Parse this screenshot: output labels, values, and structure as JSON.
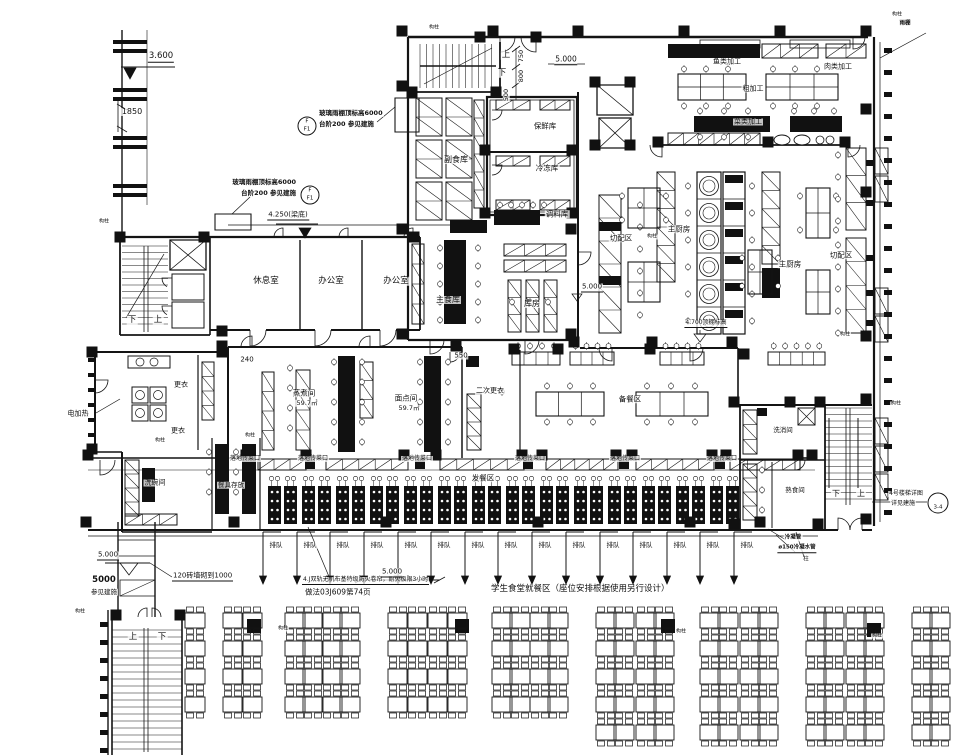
{
  "drawing": {
    "type": "cafeteria-kitchen-floor-plan",
    "main_note": "学生食堂就餐区（座位安排根据使用另行设计）",
    "fire_curtain_note_1": "4.J双轨无机布基特级防火卷帘，耐火极限3小时",
    "fire_curtain_note_2": "做法03J609第74页"
  },
  "queue": {
    "text": "排队",
    "y": 545,
    "xs": [
      273,
      307,
      340,
      374,
      408,
      441,
      475,
      508,
      542,
      576,
      610,
      643,
      677,
      710,
      744
    ]
  },
  "pass_windows": {
    "text": "落地传菜口",
    "y": 459,
    "xs": [
      245,
      313,
      417,
      530,
      625,
      722
    ]
  },
  "column_marks": {
    "text": "构柱",
    "positions": [
      [
        434,
        28
      ],
      [
        897,
        15
      ],
      [
        104,
        222
      ],
      [
        250,
        436
      ],
      [
        160,
        441
      ],
      [
        652,
        237
      ],
      [
        845,
        335
      ],
      [
        283,
        629
      ],
      [
        681,
        632
      ],
      [
        877,
        636
      ],
      [
        80,
        612
      ],
      [
        896,
        404
      ]
    ]
  },
  "stations": {
    "count": 14,
    "x0": 268,
    "dx": 34,
    "y": 486
  },
  "labels": [
    {
      "t": "3.600",
      "x": 161,
      "y": 57,
      "fs": 8.5,
      "ul": 1,
      "n": "dim-3600"
    },
    {
      "t": "1850",
      "x": 132,
      "y": 112,
      "fs": 8,
      "n": "dim-1850"
    },
    {
      "t": "玻璃雨棚顶标高6000",
      "x": 318,
      "y": 113,
      "fs": 6.5,
      "ha": "left",
      "b": 1,
      "n": "canopy-callout-1-line1"
    },
    {
      "t": "台阶200  参见建施",
      "x": 318,
      "y": 124,
      "fs": 6.5,
      "ha": "left",
      "b": 1,
      "n": "canopy-callout-1-line2"
    },
    {
      "t": "玻璃雨棚顶标高6000",
      "x": 297,
      "y": 182,
      "fs": 6.5,
      "ha": "right",
      "b": 1,
      "n": "canopy-callout-2-line1"
    },
    {
      "t": "台阶200  参见建施",
      "x": 297,
      "y": 193,
      "fs": 6.5,
      "ha": "right",
      "b": 1,
      "n": "canopy-callout-2-line2"
    },
    {
      "t": "4.250(梁底)",
      "x": 288,
      "y": 216,
      "fs": 7,
      "ul": 1,
      "n": "dim-4250"
    },
    {
      "t": "5.000",
      "x": 566,
      "y": 60,
      "fs": 7.5,
      "ul": 1,
      "n": "dim-5000-top"
    },
    {
      "t": "750",
      "x": 521,
      "y": 56,
      "fs": 6.5,
      "rot": 1,
      "n": "dim-750"
    },
    {
      "t": "800",
      "x": 521,
      "y": 76,
      "fs": 6.5,
      "rot": 1,
      "n": "dim-800"
    },
    {
      "t": "500",
      "x": 506,
      "y": 95,
      "fs": 6.5,
      "rot": 1,
      "n": "dim-500"
    },
    {
      "t": "上",
      "x": 506,
      "y": 55,
      "fs": 8.5,
      "n": "stair-up-top"
    },
    {
      "t": "下",
      "x": 502,
      "y": 73,
      "fs": 8.5,
      "n": "stair-down-top"
    },
    {
      "t": "副食库",
      "x": 456,
      "y": 160,
      "fs": 8,
      "n": "room-label-side-food-store"
    },
    {
      "t": "保鲜库",
      "x": 545,
      "y": 126,
      "fs": 7.5,
      "n": "room-label-fresh-store"
    },
    {
      "t": "冷冻库",
      "x": 547,
      "y": 168,
      "fs": 7.5,
      "n": "room-label-freezer"
    },
    {
      "t": "调料库",
      "x": 557,
      "y": 214,
      "fs": 7.5,
      "n": "room-label-seasoning-store"
    },
    {
      "t": "主食库",
      "x": 448,
      "y": 300,
      "fs": 8,
      "n": "room-label-staple-store"
    },
    {
      "t": "库房",
      "x": 532,
      "y": 304,
      "fs": 8,
      "n": "room-label-storeroom"
    },
    {
      "t": "5.000",
      "x": 592,
      "y": 288,
      "fs": 7,
      "ul": 1,
      "n": "dim-5000-mid"
    },
    {
      "t": "切配区",
      "x": 621,
      "y": 238,
      "fs": 7.5,
      "n": "zone-label-cutting-1"
    },
    {
      "t": "切配区",
      "x": 841,
      "y": 255,
      "fs": 7.5,
      "n": "zone-label-cutting-2"
    },
    {
      "t": "主厨房",
      "x": 679,
      "y": 229,
      "fs": 7.5,
      "n": "room-label-main-kitchen-1"
    },
    {
      "t": "主厨房",
      "x": 790,
      "y": 264,
      "fs": 7.5,
      "n": "room-label-main-kitchen-2"
    },
    {
      "t": "鱼类加工",
      "x": 727,
      "y": 62,
      "fs": 7,
      "n": "zone-label-fish-processing"
    },
    {
      "t": "肉类加工",
      "x": 838,
      "y": 67,
      "fs": 7,
      "n": "zone-label-meat-processing"
    },
    {
      "t": "粗加工",
      "x": 753,
      "y": 89,
      "fs": 7,
      "n": "zone-label-rough-processing"
    },
    {
      "t": "菜类加工",
      "x": 748,
      "y": 122,
      "fs": 7,
      "n": "zone-label-vegetable-processing"
    },
    {
      "t": "4.700顶棚标高",
      "x": 706,
      "y": 324,
      "fs": 6,
      "ul": 1,
      "n": "dim-4700-ceiling"
    },
    {
      "t": "休息室",
      "x": 266,
      "y": 281,
      "fs": 8.5,
      "n": "room-label-rest-room"
    },
    {
      "t": "办公室",
      "x": 331,
      "y": 281,
      "fs": 8.5,
      "n": "room-label-office-1"
    },
    {
      "t": "办公室",
      "x": 396,
      "y": 281,
      "fs": 8.5,
      "n": "room-label-office-2"
    },
    {
      "t": "下",
      "x": 132,
      "y": 320,
      "fs": 8.5,
      "n": "stair-down-left"
    },
    {
      "t": "上",
      "x": 158,
      "y": 320,
      "fs": 8.5,
      "n": "stair-up-left"
    },
    {
      "t": "更衣",
      "x": 181,
      "y": 385,
      "fs": 7,
      "n": "room-label-changing-1"
    },
    {
      "t": "更衣",
      "x": 178,
      "y": 431,
      "fs": 7,
      "n": "room-label-changing-2"
    },
    {
      "t": "电加热",
      "x": 78,
      "y": 414,
      "fs": 7,
      "n": "note-electric-heating"
    },
    {
      "t": "洗碗间",
      "x": 155,
      "y": 483,
      "fs": 7,
      "n": "room-label-dishwashing"
    },
    {
      "t": "餐具存放",
      "x": 231,
      "y": 485,
      "fs": 6.5,
      "n": "room-label-tableware-storage"
    },
    {
      "t": "蒸煮间",
      "x": 304,
      "y": 393,
      "fs": 7.5,
      "n": "room-label-steaming"
    },
    {
      "t": "59.7㎡",
      "x": 307,
      "y": 403,
      "fs": 6.5,
      "n": "area-steaming"
    },
    {
      "t": "面点间",
      "x": 406,
      "y": 398,
      "fs": 7.5,
      "n": "room-label-pastry"
    },
    {
      "t": "59.7㎡",
      "x": 409,
      "y": 408,
      "fs": 6.5,
      "n": "area-pastry"
    },
    {
      "t": "240",
      "x": 247,
      "y": 360,
      "fs": 7,
      "n": "dim-240"
    },
    {
      "t": "550",
      "x": 461,
      "y": 356,
      "fs": 7,
      "n": "dim-550"
    },
    {
      "t": "二次更衣",
      "x": 490,
      "y": 391,
      "fs": 7,
      "n": "room-label-second-changing"
    },
    {
      "t": "备餐区",
      "x": 630,
      "y": 399,
      "fs": 7.5,
      "n": "zone-label-food-prep"
    },
    {
      "t": "发餐区",
      "x": 483,
      "y": 478,
      "fs": 7.5,
      "n": "zone-label-serving"
    },
    {
      "t": "洗消间",
      "x": 783,
      "y": 430,
      "fs": 6.5,
      "n": "room-label-washing-disinfection"
    },
    {
      "t": "熟食间",
      "x": 795,
      "y": 490,
      "fs": 6.5,
      "n": "room-label-cooked-food"
    },
    {
      "t": "学生食堂就餐区（座位安排根据使用另行设计）",
      "x": 490,
      "y": 589,
      "fs": 8.5,
      "ha": "left",
      "n": "note-dining-area"
    },
    {
      "t": "4.J双轨无机布基特级防火卷帘，耐火极限3小时",
      "x": 302,
      "y": 581,
      "fs": 6,
      "ha": "left",
      "ul": 1,
      "n": "note-fire-curtain-1"
    },
    {
      "t": "做法03J609第74页",
      "x": 304,
      "y": 592,
      "fs": 7.5,
      "ha": "left",
      "n": "note-fire-curtain-2"
    },
    {
      "t": "5.000",
      "x": 392,
      "y": 573,
      "fs": 7,
      "ul": 1,
      "n": "dim-5000-bottom"
    },
    {
      "t": "5.000",
      "x": 108,
      "y": 556,
      "fs": 7,
      "ul": 1,
      "n": "dim-5000-left"
    },
    {
      "t": "5000",
      "x": 104,
      "y": 580,
      "fs": 8.5,
      "b": 1,
      "n": "dim-5000-bold"
    },
    {
      "t": "参见建施",
      "x": 104,
      "y": 592,
      "fs": 6.5,
      "n": "note-see-arch"
    },
    {
      "t": "120砖墙砌到1000",
      "x": 172,
      "y": 577,
      "fs": 7,
      "ha": "left",
      "ul": 1,
      "n": "note-brick-wall"
    },
    {
      "t": "上",
      "x": 133,
      "y": 637,
      "fs": 8.5,
      "n": "stair-up-bottom-left"
    },
    {
      "t": "下",
      "x": 162,
      "y": 637,
      "fs": 8.5,
      "n": "stair-down-bottom-left"
    },
    {
      "t": "4号楼梯详图",
      "x": 906,
      "y": 494,
      "fs": 6,
      "n": "callout-stair4-line1"
    },
    {
      "t": "详见建施",
      "x": 903,
      "y": 504,
      "fs": 6,
      "n": "callout-stair4-line2"
    },
    {
      "t": "3-4",
      "x": 938,
      "y": 508,
      "fs": 5.5,
      "n": "callout-stair4-ref"
    },
    {
      "t": "下",
      "x": 836,
      "y": 494,
      "fs": 8,
      "n": "stair-down-right"
    },
    {
      "t": "上",
      "x": 861,
      "y": 494,
      "fs": 8,
      "n": "stair-up-right"
    },
    {
      "t": "冷凝管",
      "x": 793,
      "y": 538,
      "fs": 5.5,
      "b": 1,
      "n": "note-condensate-pipe"
    },
    {
      "t": "ø150冷凝水管",
      "x": 797,
      "y": 549,
      "fs": 5.5,
      "b": 1,
      "ul": 1,
      "n": "note-condensate-150"
    },
    {
      "t": "柱",
      "x": 806,
      "y": 560,
      "fs": 5.5,
      "n": "note-column"
    },
    {
      "t": "雨棚",
      "x": 905,
      "y": 24,
      "fs": 5.5,
      "b": 1,
      "n": "note-canopy"
    },
    {
      "t": "F",
      "x": 307,
      "y": 122,
      "fs": 5.5,
      "n": "callout-bubble-1-top"
    },
    {
      "t": "F1",
      "x": 307,
      "y": 130,
      "fs": 5.5,
      "n": "callout-bubble-1-bottom"
    },
    {
      "t": "F",
      "x": 310,
      "y": 191,
      "fs": 5.5,
      "n": "callout-bubble-2-top"
    },
    {
      "t": "F1",
      "x": 310,
      "y": 199,
      "fs": 5.5,
      "n": "callout-bubble-2-bottom"
    }
  ]
}
